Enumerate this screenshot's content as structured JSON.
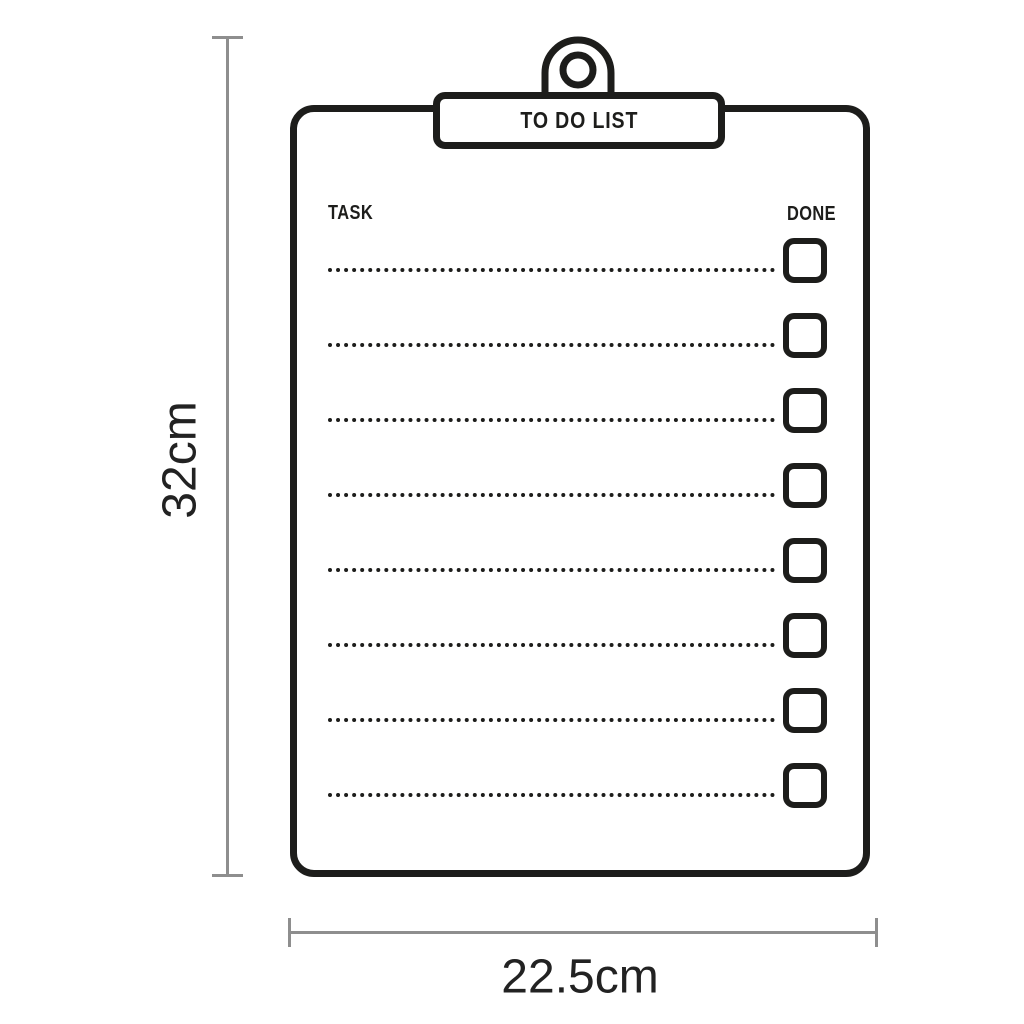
{
  "clipboard": {
    "title": "TO DO LIST",
    "task_header": "TASK",
    "done_header": "DONE",
    "rows": [
      {
        "task": "",
        "done": false
      },
      {
        "task": "",
        "done": false
      },
      {
        "task": "",
        "done": false
      },
      {
        "task": "",
        "done": false
      },
      {
        "task": "",
        "done": false
      },
      {
        "task": "",
        "done": false
      },
      {
        "task": "",
        "done": false
      },
      {
        "task": "",
        "done": false
      }
    ]
  },
  "dimensions": {
    "height_label": "32cm",
    "width_label": "22.5cm"
  },
  "colors": {
    "ink": "#1d1d1b",
    "dimension_line": "#8e8e8e",
    "background": "#ffffff"
  }
}
